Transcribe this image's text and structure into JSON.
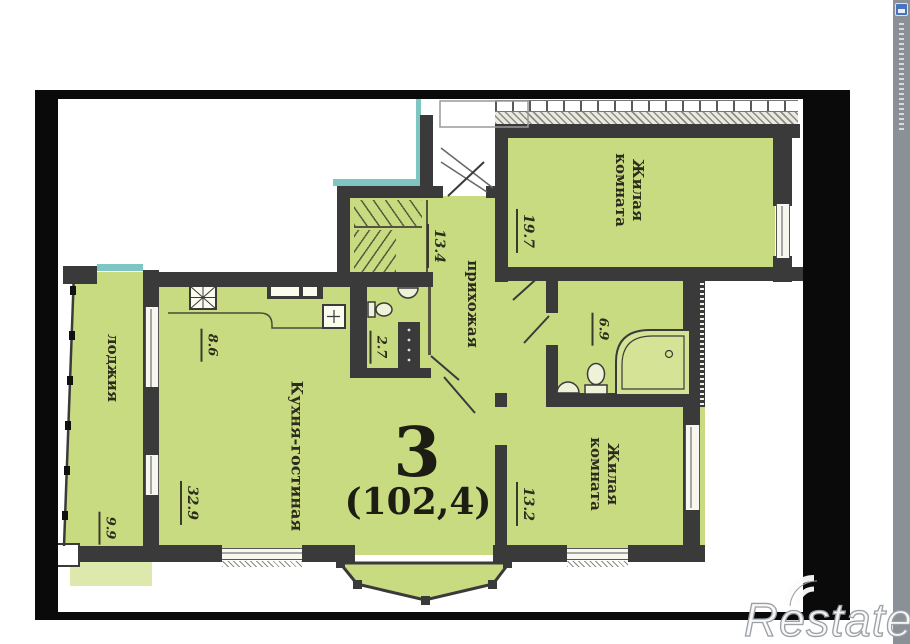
{
  "floorplan": {
    "apartment_number": "3",
    "total_area_label": "(102,4)",
    "rooms": {
      "living_room_top": {
        "name": "Жилая комната",
        "area": "19.7"
      },
      "living_room_bottom": {
        "name": "Жилая комната",
        "area": "13.2"
      },
      "kitchen_living": {
        "name": "Кухня-гостиная",
        "area": "32.9"
      },
      "kitchen_zone": {
        "area": "8.6"
      },
      "hallway": {
        "name": "прихожая",
        "area": "13.4"
      },
      "bathroom": {
        "area": "6.9"
      },
      "wc": {
        "area": "2.7"
      },
      "loggia": {
        "name": "лоджия",
        "area": "9.9"
      }
    },
    "colors": {
      "room_fill": "#c9db81",
      "slab_fill": "#dce8ac",
      "wall": "#3a3a3a",
      "accent_teal": "#7ec6c2",
      "frame": "#0a0a0a",
      "side_strip": "#8b9096"
    }
  },
  "watermark": {
    "text": "Restate"
  }
}
